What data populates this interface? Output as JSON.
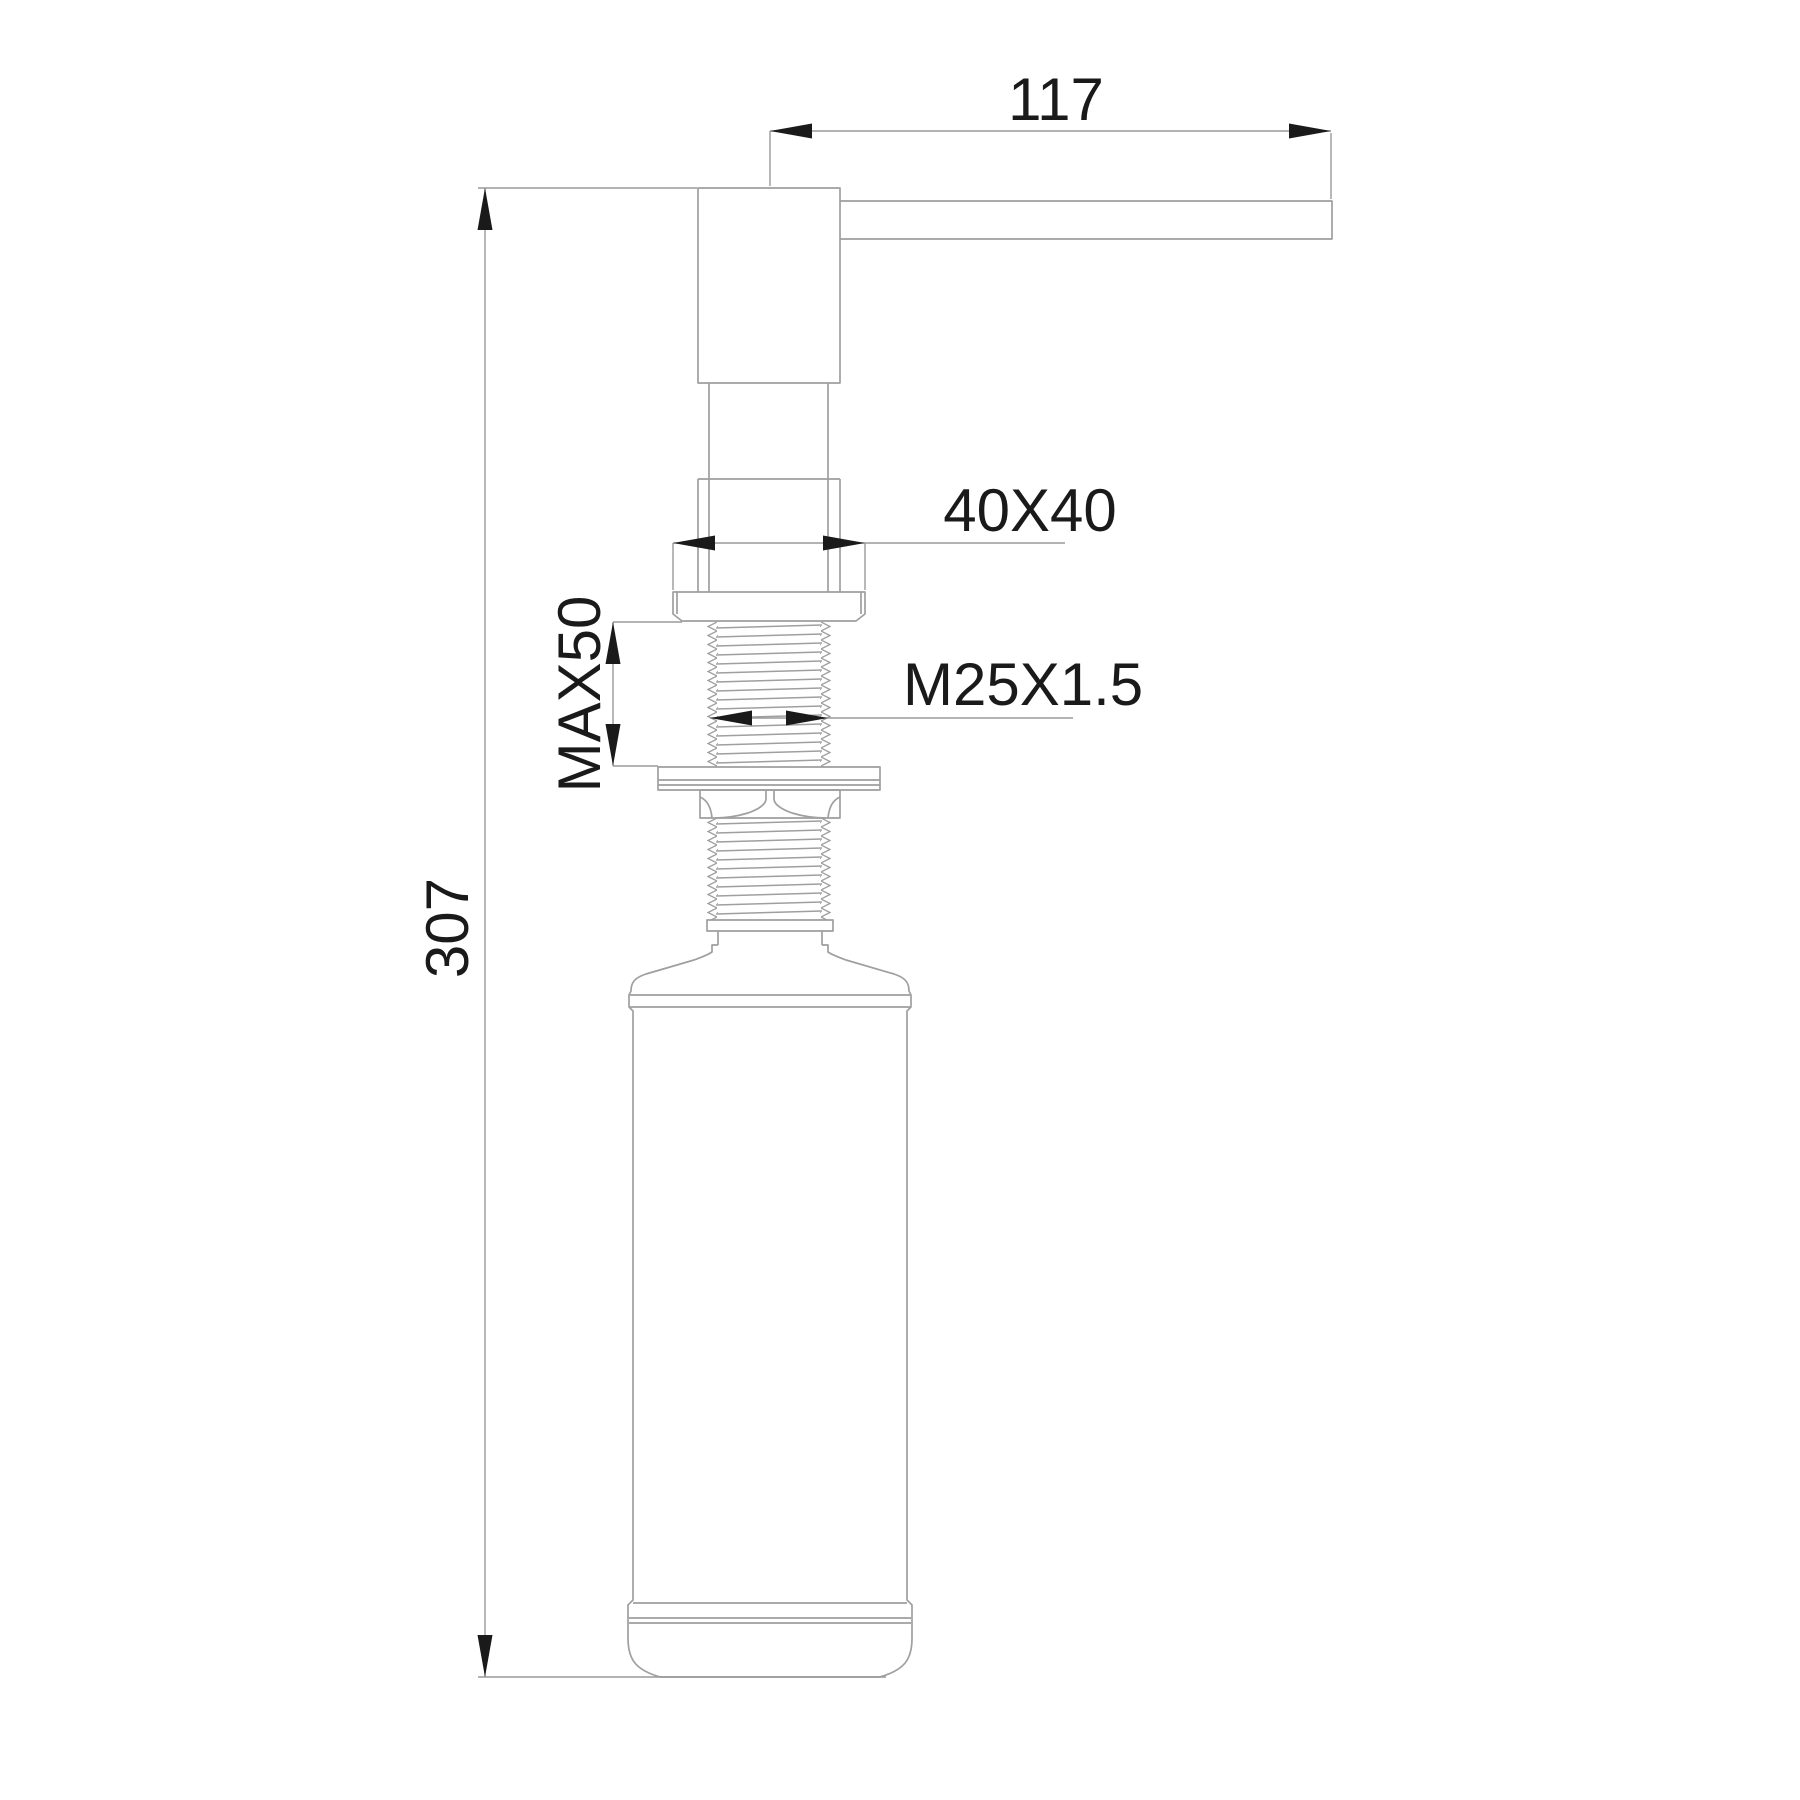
{
  "drawing": {
    "type": "technical-dimension-drawing",
    "subject": "kitchen-sink-soap-dispenser-side-view",
    "background_color": "#ffffff",
    "line_color": "#9f9f9f",
    "ink_color": "#1a1a1a",
    "dimensions": {
      "spout_length": "117",
      "escutcheon_size": "40X40",
      "max_mounting_thickness": "MAX50",
      "thread_spec": "M25X1.5",
      "overall_height": "307"
    }
  }
}
